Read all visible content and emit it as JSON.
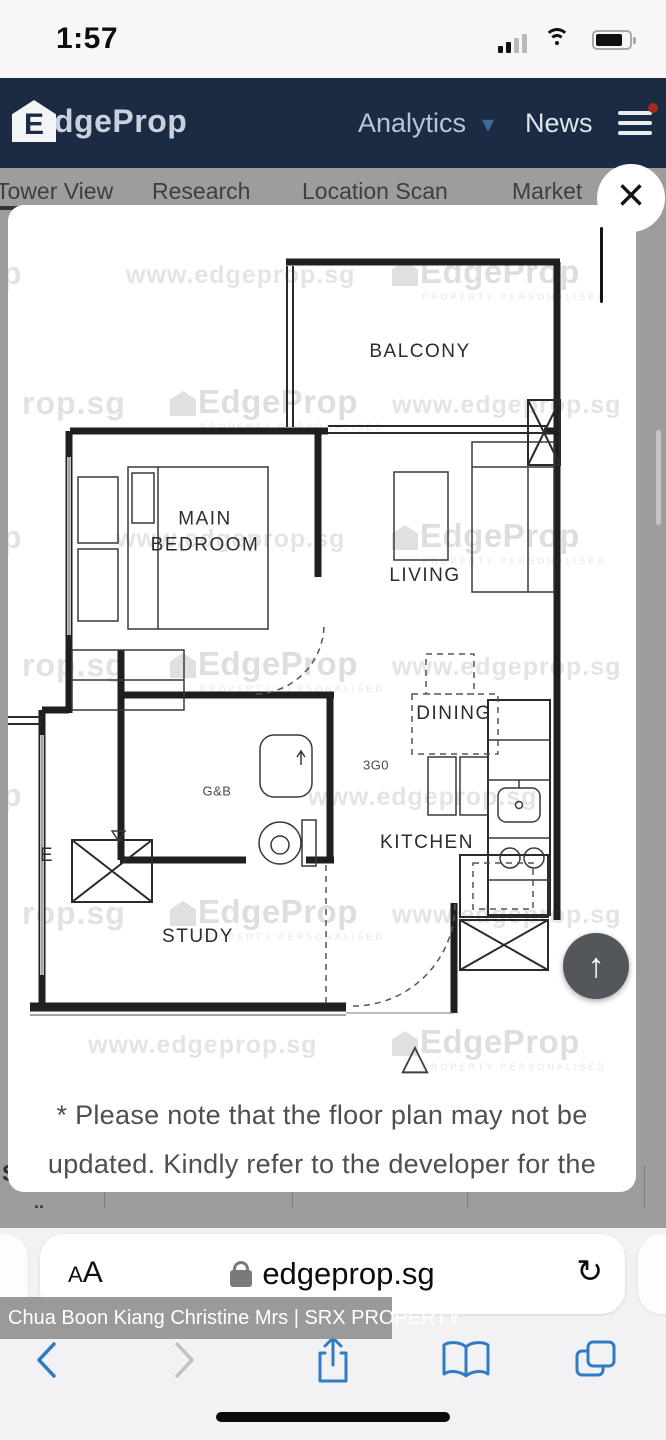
{
  "status_bar": {
    "time": "1:57"
  },
  "header": {
    "logo_initial": "E",
    "logo_rest": "dgeProp",
    "nav_analytics": "Analytics",
    "nav_chevron": "▾",
    "nav_news": "News"
  },
  "page_behind": {
    "tab_tower_view": "Tower View",
    "tab_research": "Research",
    "tab_location_scan": "Location Scan",
    "tab_market": "Market",
    "storey_label": "STOREY",
    "storey_sub": "..",
    "date_1": "30 JAN 13",
    "date_2": "30 SEP 16",
    "date_3": "05 JUN 13"
  },
  "modal": {
    "close_icon": "×",
    "watermark": {
      "logo": "EdgeProp",
      "tagline": "PROPERTY PERSONALISED",
      "url": "www.edgeprop.sg",
      "partial_a": "p",
      "partial_b": "rop.sg"
    },
    "plan": {
      "balcony": "BALCONY",
      "main_bedroom": "MAIN BEDROOM",
      "living": "LIVING",
      "dining": "DINING",
      "kitchen": "KITCHEN",
      "study": "STUDY",
      "bath_label": "G&B",
      "utility_label": "3G0",
      "stray_label": "E",
      "direction_marker": "△"
    },
    "scroll_top_icon": "↑",
    "note_line1": "* Please note that the floor plan may not be",
    "note_line2": "updated. Kindly refer to the developer for the"
  },
  "browser": {
    "reader_a1": "A",
    "reader_a2": "A",
    "url": "edgeprop.sg",
    "reload_icon": "↻",
    "agent_banner": "Chua Boon Kiang Christine Mrs  | SRX PROPERTY"
  },
  "colors": {
    "header_bg": "#1b2b44",
    "accent_blue": "#3e79c0",
    "overlay_gray": "#9d9d9d",
    "toolbar_icon_blue": "#2f7cc4",
    "scroll_button": "#53575c"
  }
}
